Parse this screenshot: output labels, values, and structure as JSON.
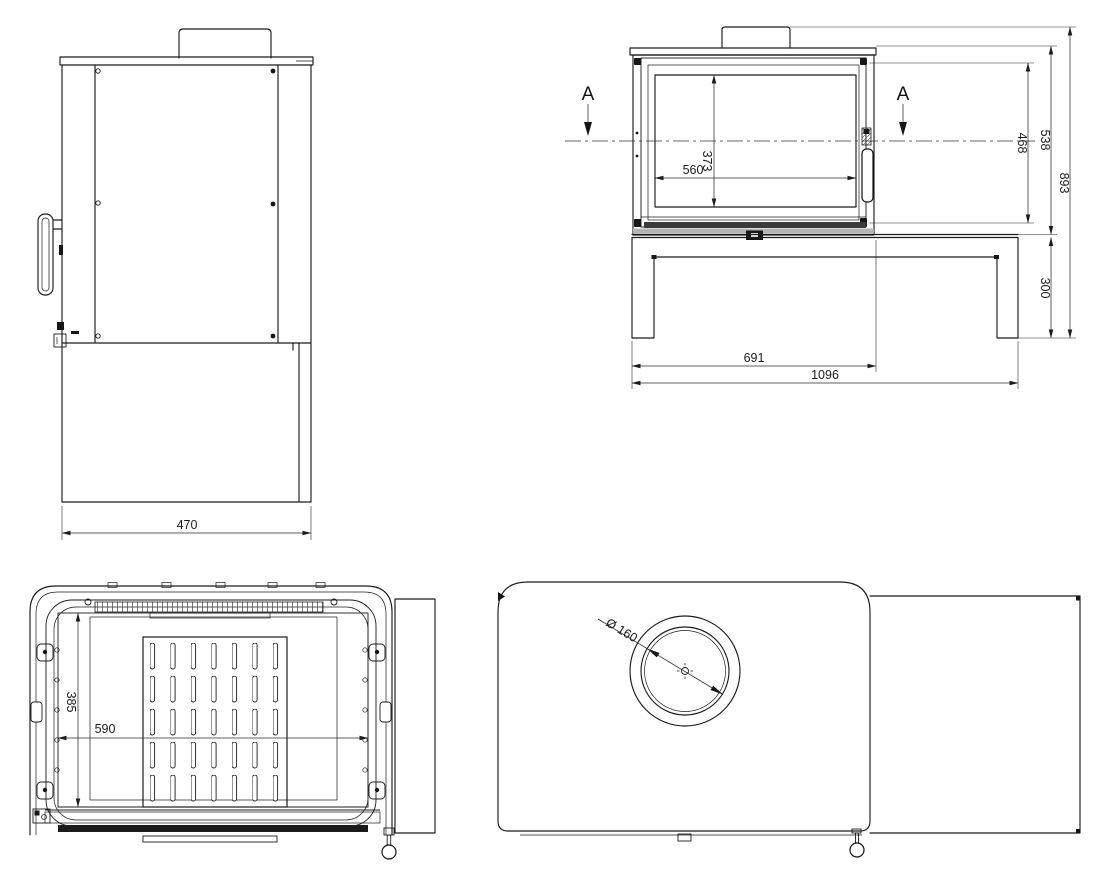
{
  "drawing": {
    "type": "technical-drawing",
    "line_color": "#1c1c1c",
    "background": "#ffffff",
    "views": {
      "side": {
        "label": "side-view",
        "dims": {
          "depth": "470"
        }
      },
      "front": {
        "label": "front-view",
        "section_marker": "A",
        "dims": {
          "glass_width": "560",
          "glass_height": "373",
          "door_height": "468",
          "body_height": "538",
          "total_height": "893",
          "base_height": "300",
          "stove_width": "691",
          "total_width": "1096"
        }
      },
      "section": {
        "label": "section-a-a-view",
        "dims": {
          "opening_height": "385",
          "opening_width": "590"
        }
      },
      "top": {
        "label": "top-view",
        "dims": {
          "flue_diameter": "Ø 160"
        }
      }
    }
  }
}
